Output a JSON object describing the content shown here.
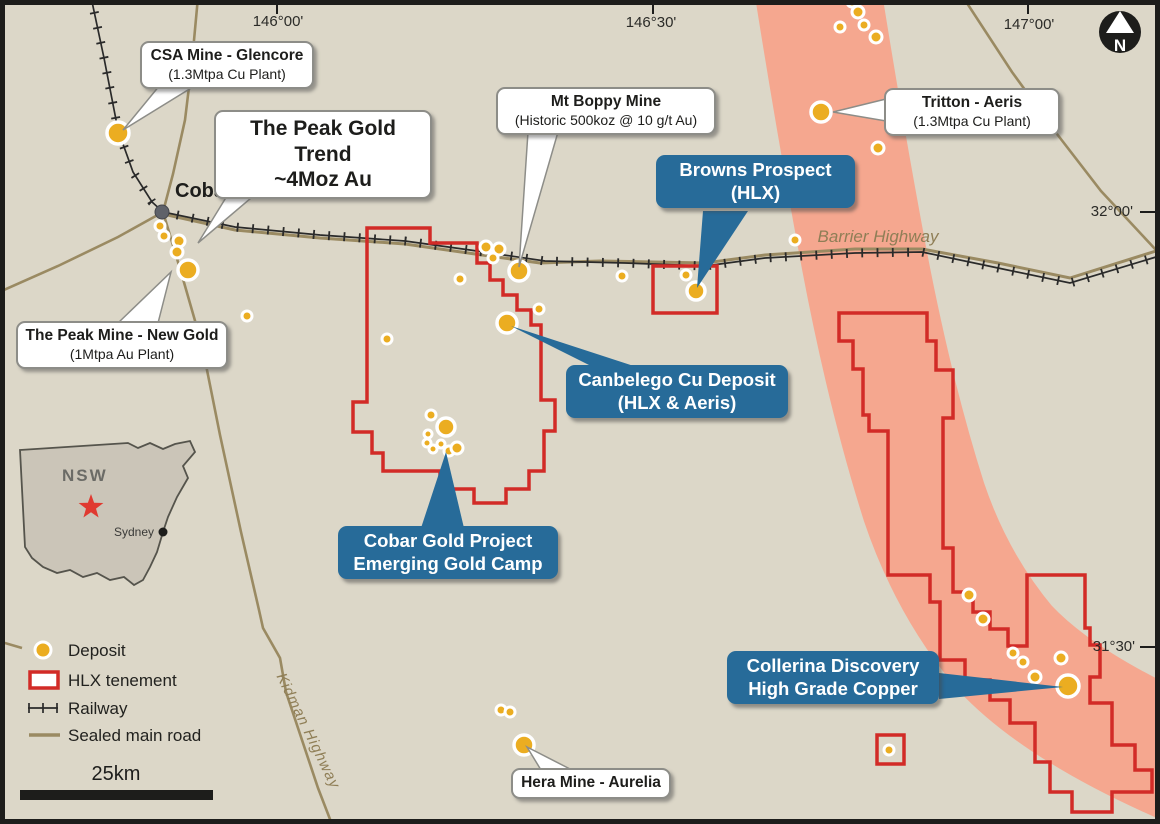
{
  "map": {
    "title_region": "Cobar",
    "coordinates": {
      "top": [
        "146°00'",
        "146°30'",
        "147°00'"
      ],
      "right": [
        "32°00'",
        "31°30'"
      ]
    },
    "north_label": "N",
    "town": {
      "name": "Cobar"
    },
    "road_labels": {
      "barrier": "Barrier Highway",
      "kidman": "Kidman Highway"
    },
    "callouts": {
      "csa": {
        "line1": "CSA Mine - Glencore",
        "line2": "(1.3Mtpa Cu Plant)"
      },
      "peak_trend": {
        "line1": "The Peak Gold Trend",
        "line2": "~4Moz Au"
      },
      "boppy": {
        "line1": "Mt Boppy Mine",
        "line2": "(Historic 500koz @ 10 g/t Au)"
      },
      "tritton": {
        "line1": "Tritton - Aeris",
        "line2": "(1.3Mtpa Cu Plant)"
      },
      "peak_mine": {
        "line1": "The Peak Mine - New Gold",
        "line2": "(1Mtpa Au Plant)"
      },
      "hera": {
        "line1": "Hera Mine - Aurelia"
      },
      "browns": {
        "line1": "Browns Prospect",
        "line2": "(HLX)"
      },
      "canbelego": {
        "line1": "Canbelego Cu Deposit",
        "line2": "(HLX & Aeris)"
      },
      "cobar_gold": {
        "line1": "Cobar Gold Project",
        "line2": "Emerging Gold Camp"
      },
      "collerina": {
        "line1": "Collerina Discovery",
        "line2": "High Grade Copper"
      }
    },
    "inset": {
      "region": "NSW",
      "city": "Sydney"
    },
    "legend": {
      "items": [
        {
          "label": "Deposit"
        },
        {
          "label": "HLX tenement"
        },
        {
          "label": "Railway"
        },
        {
          "label": "Sealed main road"
        }
      ],
      "scale_label": "25km"
    },
    "colors": {
      "background": "#DCD7C8",
      "salmon_belt": "#F5A78F",
      "tenement_red": "#D22B27",
      "callout_blue": "#276B99",
      "deposit_yellow": "#EBAD21",
      "road_brown": "#9A8A62",
      "railway_black": "#2A2A2A",
      "frame_black": "#1D1D1B"
    },
    "deposits": [
      {
        "x": 118,
        "y": 133,
        "r": 11,
        "size": "major"
      },
      {
        "x": 160,
        "y": 226,
        "r": 5,
        "size": "minor"
      },
      {
        "x": 164,
        "y": 236,
        "r": 5,
        "size": "minor"
      },
      {
        "x": 179,
        "y": 241,
        "r": 6,
        "size": "minor"
      },
      {
        "x": 177,
        "y": 252,
        "r": 6,
        "size": "minor"
      },
      {
        "x": 188,
        "y": 270,
        "r": 10,
        "size": "major"
      },
      {
        "x": 247,
        "y": 316,
        "r": 5,
        "size": "minor"
      },
      {
        "x": 387,
        "y": 339,
        "r": 5,
        "size": "minor"
      },
      {
        "x": 460,
        "y": 279,
        "r": 5,
        "size": "minor"
      },
      {
        "x": 486,
        "y": 247,
        "r": 6,
        "size": "minor"
      },
      {
        "x": 499,
        "y": 249,
        "r": 6,
        "size": "minor"
      },
      {
        "x": 493,
        "y": 258,
        "r": 5,
        "size": "minor"
      },
      {
        "x": 519,
        "y": 271,
        "r": 10,
        "size": "major"
      },
      {
        "x": 539,
        "y": 309,
        "r": 5,
        "size": "minor"
      },
      {
        "x": 507,
        "y": 323,
        "r": 10,
        "size": "major"
      },
      {
        "x": 622,
        "y": 276,
        "r": 5,
        "size": "minor"
      },
      {
        "x": 686,
        "y": 275,
        "r": 5,
        "size": "minor"
      },
      {
        "x": 696,
        "y": 291,
        "r": 9,
        "size": "major"
      },
      {
        "x": 795,
        "y": 240,
        "r": 5,
        "size": "minor"
      },
      {
        "x": 852,
        "y": 2,
        "r": 5,
        "size": "minor"
      },
      {
        "x": 840,
        "y": 27,
        "r": 5,
        "size": "minor"
      },
      {
        "x": 858,
        "y": 12,
        "r": 6,
        "size": "minor"
      },
      {
        "x": 864,
        "y": 25,
        "r": 5,
        "size": "minor"
      },
      {
        "x": 876,
        "y": 37,
        "r": 6,
        "size": "minor"
      },
      {
        "x": 878,
        "y": 148,
        "r": 6,
        "size": "minor"
      },
      {
        "x": 821,
        "y": 112,
        "r": 10,
        "size": "major"
      },
      {
        "x": 431,
        "y": 415,
        "r": 5,
        "size": "minor"
      },
      {
        "x": 446,
        "y": 427,
        "r": 9,
        "size": "major"
      },
      {
        "x": 428,
        "y": 434,
        "r": 4,
        "size": "minor"
      },
      {
        "x": 427,
        "y": 443,
        "r": 4,
        "size": "minor"
      },
      {
        "x": 433,
        "y": 449,
        "r": 4,
        "size": "minor"
      },
      {
        "x": 441,
        "y": 444,
        "r": 4,
        "size": "minor"
      },
      {
        "x": 449,
        "y": 451,
        "r": 5,
        "size": "minor"
      },
      {
        "x": 457,
        "y": 448,
        "r": 6,
        "size": "minor"
      },
      {
        "x": 969,
        "y": 595,
        "r": 6,
        "size": "minor"
      },
      {
        "x": 983,
        "y": 619,
        "r": 6,
        "size": "minor"
      },
      {
        "x": 1013,
        "y": 653,
        "r": 5,
        "size": "minor"
      },
      {
        "x": 1023,
        "y": 662,
        "r": 5,
        "size": "minor"
      },
      {
        "x": 1035,
        "y": 677,
        "r": 6,
        "size": "minor"
      },
      {
        "x": 1061,
        "y": 658,
        "r": 6,
        "size": "minor"
      },
      {
        "x": 1068,
        "y": 686,
        "r": 11,
        "size": "major"
      },
      {
        "x": 889,
        "y": 750,
        "r": 5,
        "size": "minor"
      },
      {
        "x": 501,
        "y": 710,
        "r": 5,
        "size": "minor"
      },
      {
        "x": 510,
        "y": 712,
        "r": 5,
        "size": "minor"
      },
      {
        "x": 524,
        "y": 745,
        "r": 10,
        "size": "major"
      }
    ]
  }
}
